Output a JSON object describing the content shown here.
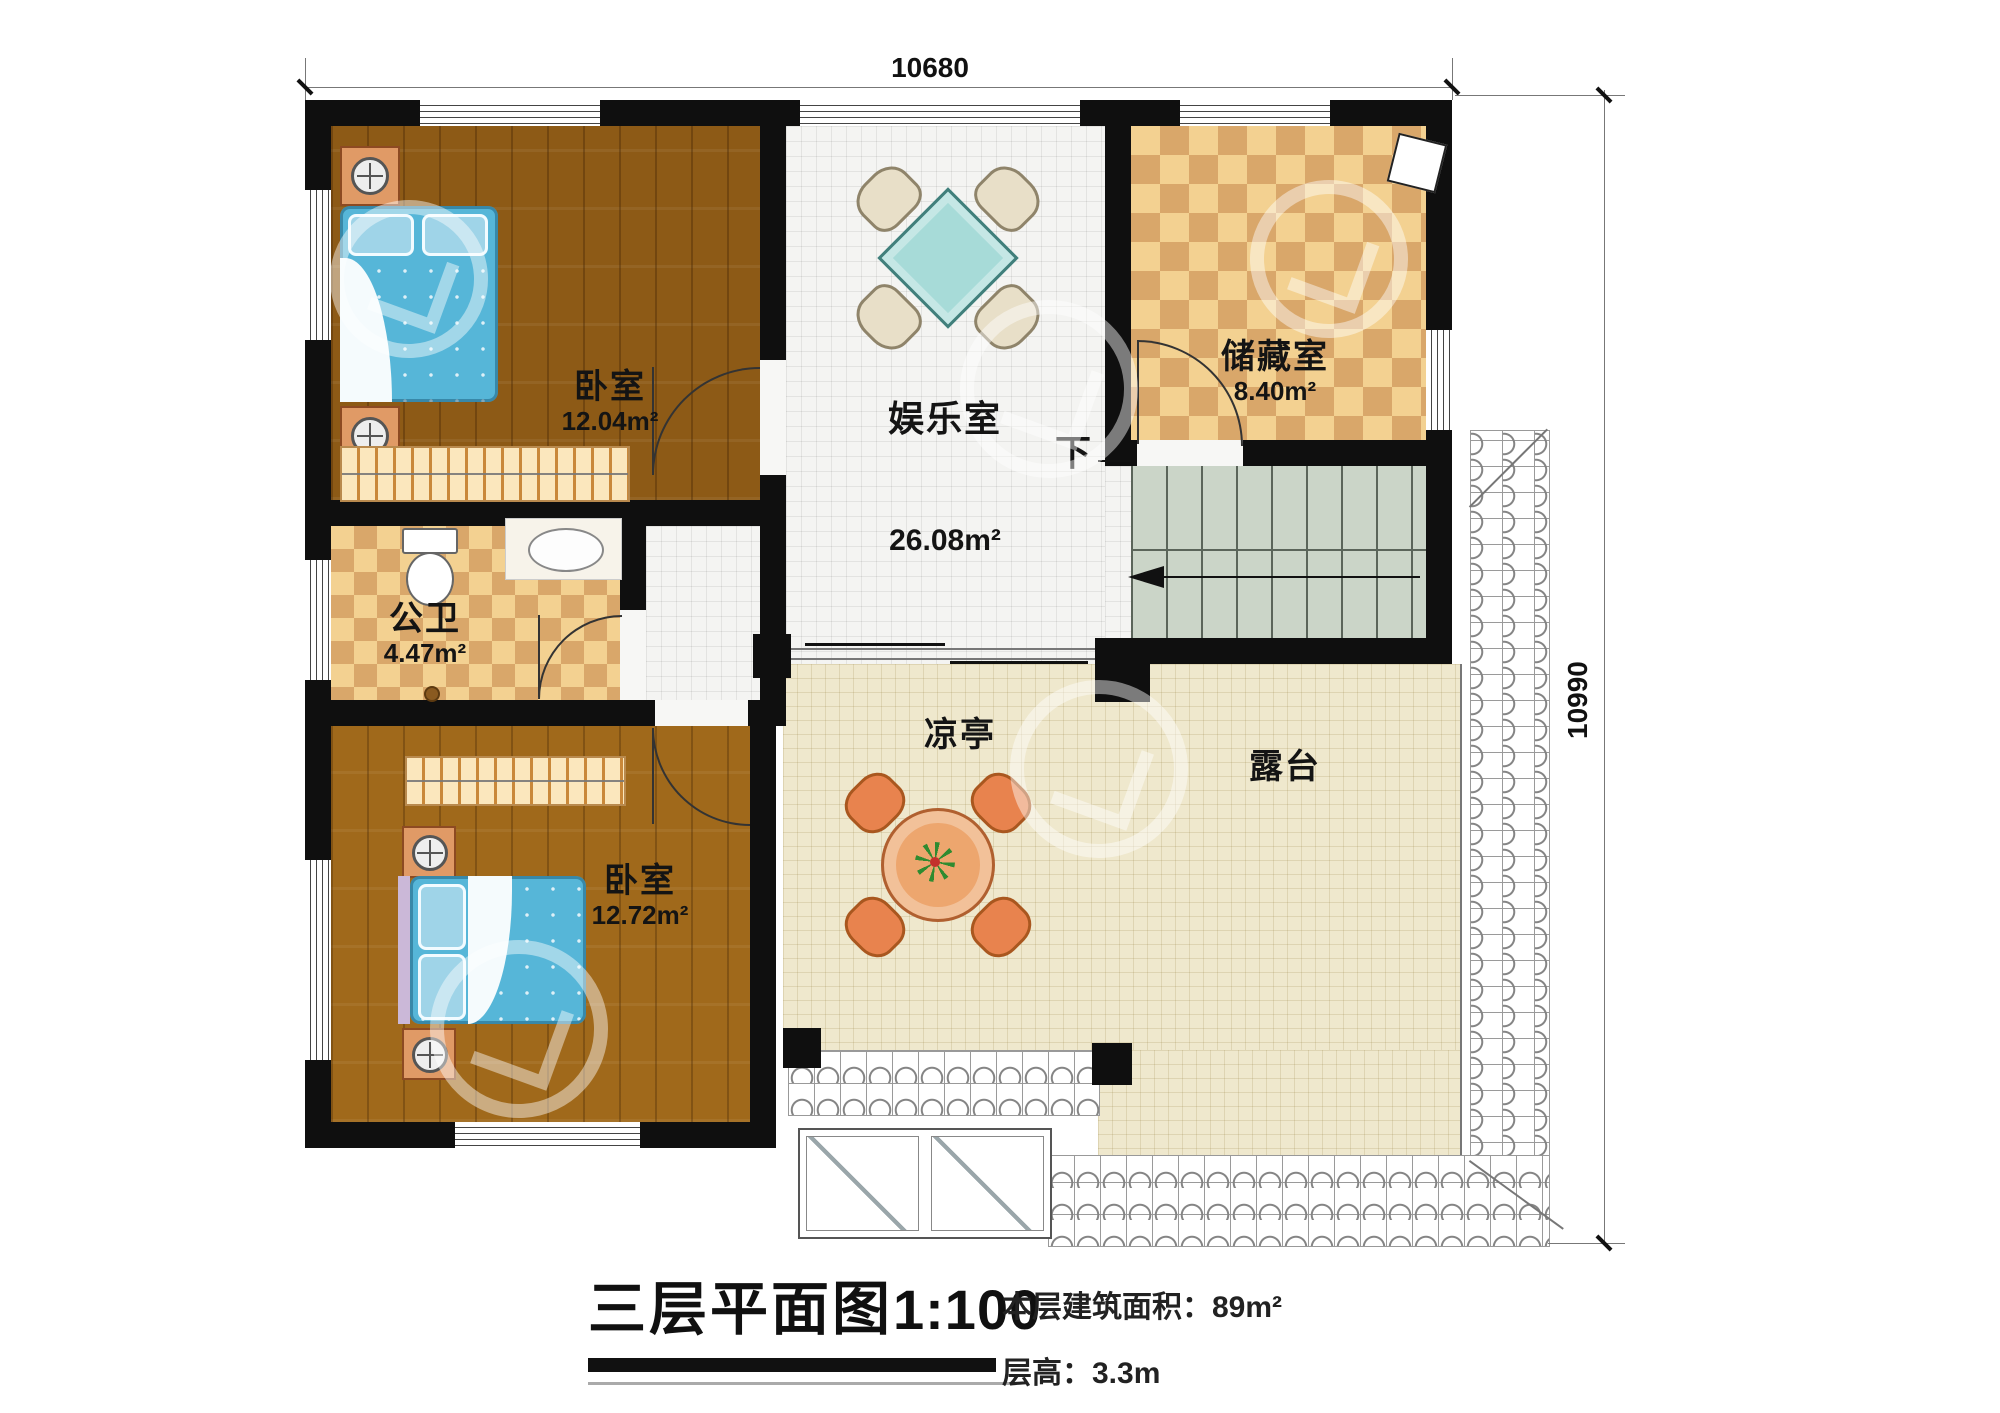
{
  "dimensions": {
    "top": "10680",
    "right": "10990"
  },
  "rooms": {
    "bedroom_top": {
      "name": "卧室",
      "area": "12.04m²"
    },
    "bedroom_bottom": {
      "name": "卧室",
      "area": "12.72m²"
    },
    "bathroom": {
      "name": "公卫",
      "area": "4.47m²"
    },
    "storage": {
      "name": "储藏室",
      "area": "8.40m²"
    },
    "entertainment": {
      "name": "娱乐室",
      "area": "26.08m²"
    },
    "pavilion": {
      "name": "凉亭"
    },
    "terrace": {
      "name": "露台"
    },
    "stairs": {
      "down_label": "下"
    }
  },
  "title_block": {
    "title": "三层平面图",
    "scale": "1:100",
    "floor_area": "本层建筑面积：89m²",
    "floor_height": "层高：3.3m"
  }
}
